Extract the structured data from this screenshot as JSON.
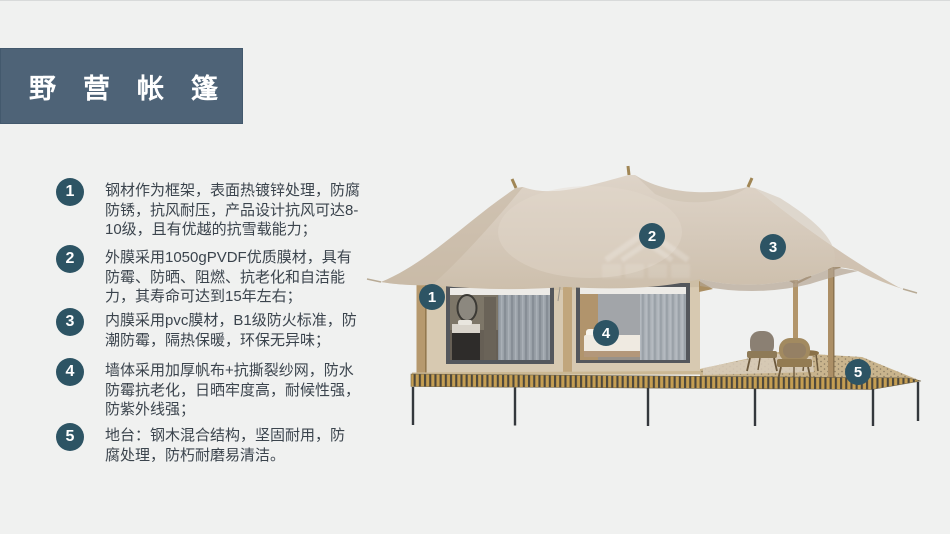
{
  "title": {
    "label": "野营帐篷"
  },
  "colors": {
    "accent": "#2d5464",
    "title_bg": "#4e6377",
    "body_text": "#3b444d",
    "page_bg": "#f0f1f0",
    "roof_fabric": "#d5c9ba",
    "cabin_wall": "#d7c9b1",
    "wood_post": "#b5996f",
    "deck_stripe_gold": "#c59e52",
    "deck_stripe_dark": "#4c473c"
  },
  "features": [
    {
      "num": "1",
      "text": "钢材作为框架，表面热镀锌处理，防腐\n防锈，抗风耐压，产品设计抗风可达8-\n10级，且有优越的抗雪载能力；"
    },
    {
      "num": "2",
      "text": "外膜采用1050gPVDF优质膜材，具有\n防霉、防晒、阻燃、抗老化和自洁能\n力，其寿命可达到15年左右；"
    },
    {
      "num": "3",
      "text": "内膜采用pvc膜材，B1级防火标准，防\n潮防霉，隔热保暖，环保无异味；"
    },
    {
      "num": "4",
      "text": "墙体采用加厚帆布+抗撕裂纱网，防水\n防霉抗老化，日晒牢度高，耐候性强，\n防紫外线强；"
    },
    {
      "num": "5",
      "text": "地台：钢木混合结构，坚固耐用，防\n腐处理，防朽耐磨易清洁。"
    }
  ],
  "callouts": [
    {
      "num": "1"
    },
    {
      "num": "2"
    },
    {
      "num": "3"
    },
    {
      "num": "4"
    },
    {
      "num": "5"
    }
  ]
}
